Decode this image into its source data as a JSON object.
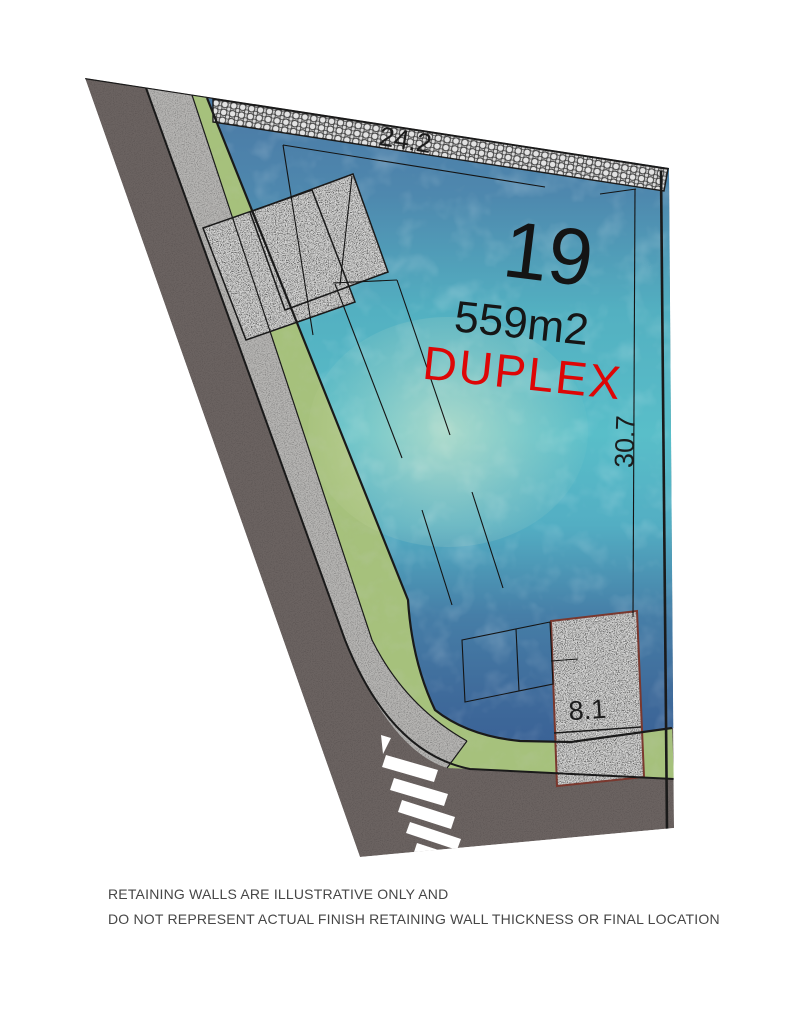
{
  "plan": {
    "title": "Lot plan",
    "lot_number": "19",
    "area_label": "559m2",
    "type_label": "DUPLEX",
    "dimensions": {
      "top_boundary": "24.2",
      "right_boundary": "30.7",
      "bottom_driveway": "8.1"
    },
    "disclaimer_line1": "RETAINING WALLS ARE ILLUSTRATIVE ONLY AND",
    "disclaimer_line2": "DO NOT REPRESENT ACTUAL FINISH RETAINING WALL THICKNESS OR FINAL LOCATION",
    "colors": {
      "road": "#6b6361",
      "footpath": "#b5b4b2",
      "grass_verge": "#a6c17c",
      "driveway_concrete": "#c6c6c5",
      "driveway_lower_outline": "#7a382e",
      "retaining_hatch_bg": "#d9d9d9",
      "retaining_hatch_ring": "#3a3a3a",
      "lot_blue_top": "#4b79a5",
      "lot_teal_mid": "#59bec9",
      "lot_blue_bottom": "#3a6296",
      "duplex_label": "#de0606",
      "line_color": "#1a1a1a",
      "crosswalk": "#ffffff"
    }
  }
}
